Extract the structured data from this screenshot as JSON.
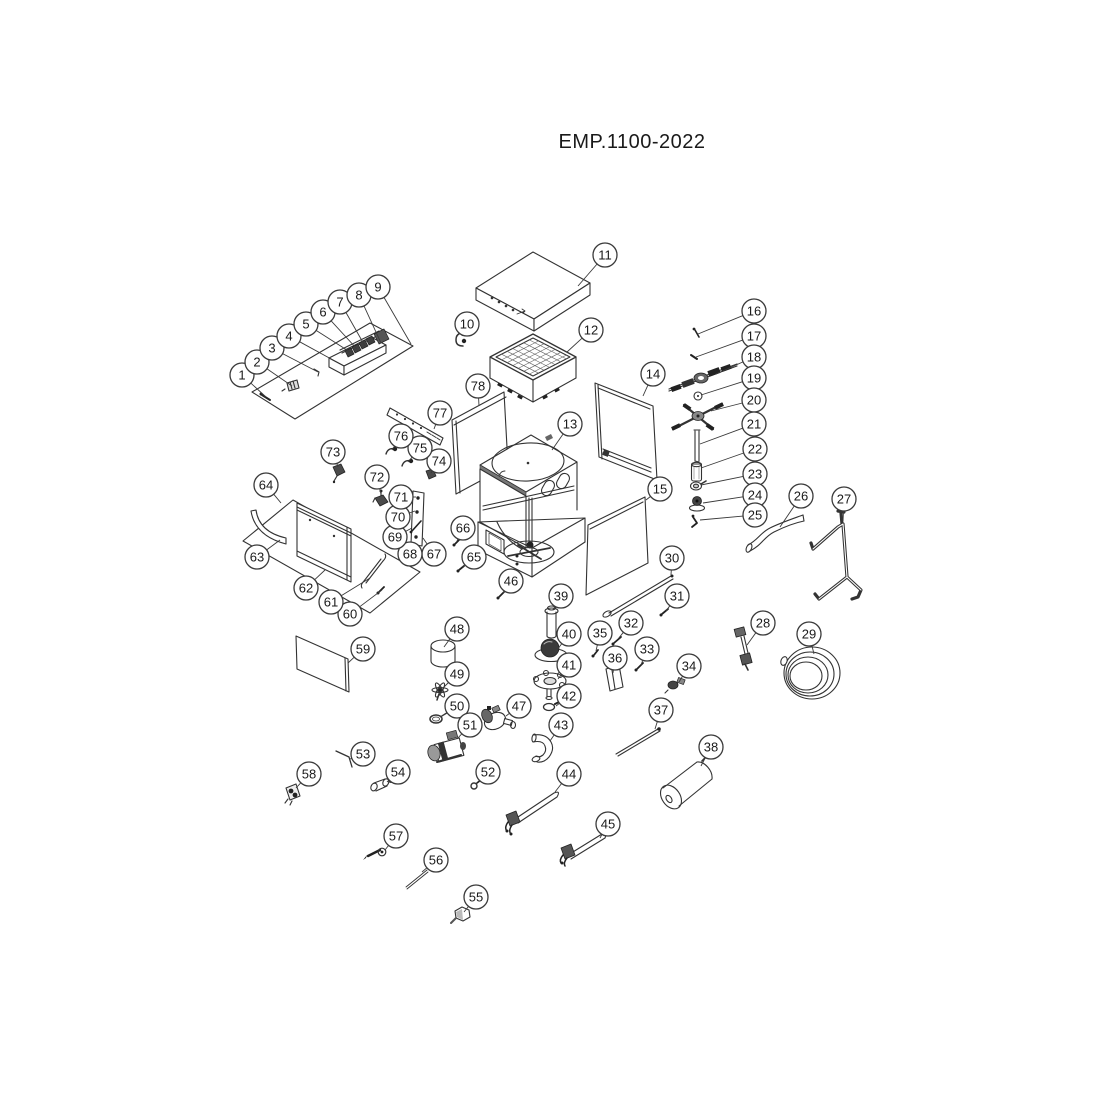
{
  "title": "EMP.1100-2022",
  "diagram": {
    "type": "exploded-parts-diagram",
    "part_count": 78,
    "callouts": [
      {
        "n": 1,
        "c": [
          242,
          375
        ],
        "t": [
          266,
          397
        ]
      },
      {
        "n": 2,
        "c": [
          257,
          362
        ],
        "t": [
          292,
          386
        ]
      },
      {
        "n": 3,
        "c": [
          272,
          348
        ],
        "t": [
          318,
          372
        ]
      },
      {
        "n": 4,
        "c": [
          289,
          336
        ],
        "t": [
          333,
          360
        ]
      },
      {
        "n": 5,
        "c": [
          306,
          324
        ],
        "t": [
          350,
          352
        ]
      },
      {
        "n": 6,
        "c": [
          323,
          312
        ],
        "t": [
          357,
          349
        ]
      },
      {
        "n": 7,
        "c": [
          340,
          302
        ],
        "t": [
          365,
          346
        ]
      },
      {
        "n": 8,
        "c": [
          359,
          295
        ],
        "t": [
          381,
          343
        ]
      },
      {
        "n": 9,
        "c": [
          378,
          287
        ],
        "t": [
          411,
          344
        ]
      },
      {
        "n": 10,
        "c": [
          467,
          324
        ],
        "t": [
          462,
          336
        ]
      },
      {
        "n": 11,
        "c": [
          605,
          255
        ],
        "t": [
          578,
          286
        ]
      },
      {
        "n": 12,
        "c": [
          591,
          330
        ],
        "t": [
          567,
          352
        ]
      },
      {
        "n": 13,
        "c": [
          570,
          424
        ],
        "t": [
          552,
          450
        ]
      },
      {
        "n": 14,
        "c": [
          653,
          374
        ],
        "t": [
          643,
          396
        ]
      },
      {
        "n": 15,
        "c": [
          660,
          489
        ],
        "t": [
          646,
          500
        ]
      },
      {
        "n": 16,
        "c": [
          754,
          311
        ],
        "t": [
          698,
          334
        ]
      },
      {
        "n": 17,
        "c": [
          754,
          336
        ],
        "t": [
          696,
          357
        ]
      },
      {
        "n": 18,
        "c": [
          754,
          357
        ],
        "t": [
          716,
          374
        ]
      },
      {
        "n": 19,
        "c": [
          754,
          378
        ],
        "t": [
          701,
          395
        ]
      },
      {
        "n": 20,
        "c": [
          754,
          400
        ],
        "t": [
          711,
          411
        ]
      },
      {
        "n": 21,
        "c": [
          754,
          424
        ],
        "t": [
          700,
          444
        ]
      },
      {
        "n": 22,
        "c": [
          755,
          449
        ],
        "t": [
          701,
          468
        ]
      },
      {
        "n": 23,
        "c": [
          755,
          474
        ],
        "t": [
          701,
          485
        ]
      },
      {
        "n": 24,
        "c": [
          755,
          495
        ],
        "t": [
          703,
          503
        ]
      },
      {
        "n": 25,
        "c": [
          755,
          515
        ],
        "t": [
          700,
          520
        ]
      },
      {
        "n": 26,
        "c": [
          801,
          496
        ],
        "t": [
          780,
          527
        ]
      },
      {
        "n": 27,
        "c": [
          844,
          499
        ],
        "t": [
          843,
          521
        ]
      },
      {
        "n": 28,
        "c": [
          763,
          623
        ],
        "t": [
          747,
          645
        ]
      },
      {
        "n": 29,
        "c": [
          809,
          634
        ],
        "t": [
          814,
          654
        ]
      },
      {
        "n": 30,
        "c": [
          672,
          558
        ],
        "t": [
          671,
          575
        ]
      },
      {
        "n": 31,
        "c": [
          677,
          596
        ],
        "t": [
          666,
          611
        ]
      },
      {
        "n": 32,
        "c": [
          631,
          623
        ],
        "t": [
          618,
          639
        ]
      },
      {
        "n": 33,
        "c": [
          647,
          649
        ],
        "t": [
          641,
          665
        ]
      },
      {
        "n": 34,
        "c": [
          689,
          666
        ],
        "t": [
          679,
          682
        ]
      },
      {
        "n": 35,
        "c": [
          600,
          633
        ],
        "t": [
          596,
          651
        ]
      },
      {
        "n": 36,
        "c": [
          615,
          658
        ],
        "t": [
          613,
          673
        ]
      },
      {
        "n": 37,
        "c": [
          661,
          710
        ],
        "t": [
          655,
          729
        ]
      },
      {
        "n": 38,
        "c": [
          711,
          747
        ],
        "t": [
          701,
          766
        ]
      },
      {
        "n": 39,
        "c": [
          561,
          596
        ],
        "t": [
          553,
          610
        ]
      },
      {
        "n": 40,
        "c": [
          569,
          634
        ],
        "t": [
          557,
          650
        ]
      },
      {
        "n": 41,
        "c": [
          569,
          665
        ],
        "t": [
          558,
          679
        ]
      },
      {
        "n": 42,
        "c": [
          569,
          696
        ],
        "t": [
          556,
          706
        ]
      },
      {
        "n": 43,
        "c": [
          561,
          725
        ],
        "t": [
          550,
          741
        ]
      },
      {
        "n": 44,
        "c": [
          569,
          774
        ],
        "t": [
          555,
          792
        ]
      },
      {
        "n": 45,
        "c": [
          608,
          824
        ],
        "t": [
          600,
          838
        ]
      },
      {
        "n": 46,
        "c": [
          511,
          581
        ],
        "t": [
          503,
          593
        ]
      },
      {
        "n": 47,
        "c": [
          519,
          706
        ],
        "t": [
          506,
          716
        ]
      },
      {
        "n": 48,
        "c": [
          457,
          629
        ],
        "t": [
          444,
          647
        ]
      },
      {
        "n": 49,
        "c": [
          457,
          674
        ],
        "t": [
          443,
          688
        ]
      },
      {
        "n": 50,
        "c": [
          457,
          706
        ],
        "t": [
          440,
          717
        ]
      },
      {
        "n": 51,
        "c": [
          470,
          725
        ],
        "t": [
          457,
          739
        ]
      },
      {
        "n": 52,
        "c": [
          488,
          772
        ],
        "t": [
          479,
          782
        ]
      },
      {
        "n": 53,
        "c": [
          363,
          754
        ],
        "t": [
          350,
          759
        ]
      },
      {
        "n": 54,
        "c": [
          398,
          772
        ],
        "t": [
          387,
          782
        ]
      },
      {
        "n": 55,
        "c": [
          476,
          897
        ],
        "t": [
          464,
          912
        ]
      },
      {
        "n": 56,
        "c": [
          436,
          860
        ],
        "t": [
          422,
          872
        ]
      },
      {
        "n": 57,
        "c": [
          396,
          836
        ],
        "t": [
          385,
          850
        ]
      },
      {
        "n": 58,
        "c": [
          309,
          774
        ],
        "t": [
          296,
          788
        ]
      },
      {
        "n": 59,
        "c": [
          363,
          649
        ],
        "t": [
          348,
          663
        ]
      },
      {
        "n": 60,
        "c": [
          350,
          614
        ],
        "t": [
          382,
          590
        ]
      },
      {
        "n": 61,
        "c": [
          331,
          602
        ],
        "t": [
          370,
          578
        ]
      },
      {
        "n": 62,
        "c": [
          306,
          588
        ],
        "t": [
          325,
          570
        ]
      },
      {
        "n": 63,
        "c": [
          257,
          557
        ],
        "t": [
          280,
          540
        ]
      },
      {
        "n": 64,
        "c": [
          266,
          485
        ],
        "t": [
          281,
          503
        ]
      },
      {
        "n": 65,
        "c": [
          474,
          557
        ],
        "t": [
          462,
          567
        ]
      },
      {
        "n": 66,
        "c": [
          463,
          528
        ],
        "t": [
          457,
          541
        ]
      },
      {
        "n": 67,
        "c": [
          434,
          554
        ],
        "t": [
          423,
          538
        ]
      },
      {
        "n": 68,
        "c": [
          410,
          554
        ],
        "t": [
          417,
          544
        ]
      },
      {
        "n": 69,
        "c": [
          395,
          537
        ],
        "t": [
          412,
          528
        ]
      },
      {
        "n": 70,
        "c": [
          398,
          517
        ],
        "t": [
          415,
          511
        ]
      },
      {
        "n": 71,
        "c": [
          401,
          497
        ],
        "t": [
          416,
          497
        ]
      },
      {
        "n": 72,
        "c": [
          377,
          477
        ],
        "t": [
          381,
          494
        ]
      },
      {
        "n": 73,
        "c": [
          333,
          452
        ],
        "t": [
          338,
          467
        ]
      },
      {
        "n": 74,
        "c": [
          439,
          461
        ],
        "t": [
          431,
          473
        ]
      },
      {
        "n": 75,
        "c": [
          420,
          448
        ],
        "t": [
          408,
          462
        ]
      },
      {
        "n": 76,
        "c": [
          401,
          436
        ],
        "t": [
          392,
          450
        ]
      },
      {
        "n": 77,
        "c": [
          440,
          413
        ],
        "t": [
          434,
          429
        ]
      },
      {
        "n": 78,
        "c": [
          478,
          386
        ],
        "t": [
          479,
          406
        ]
      }
    ]
  }
}
